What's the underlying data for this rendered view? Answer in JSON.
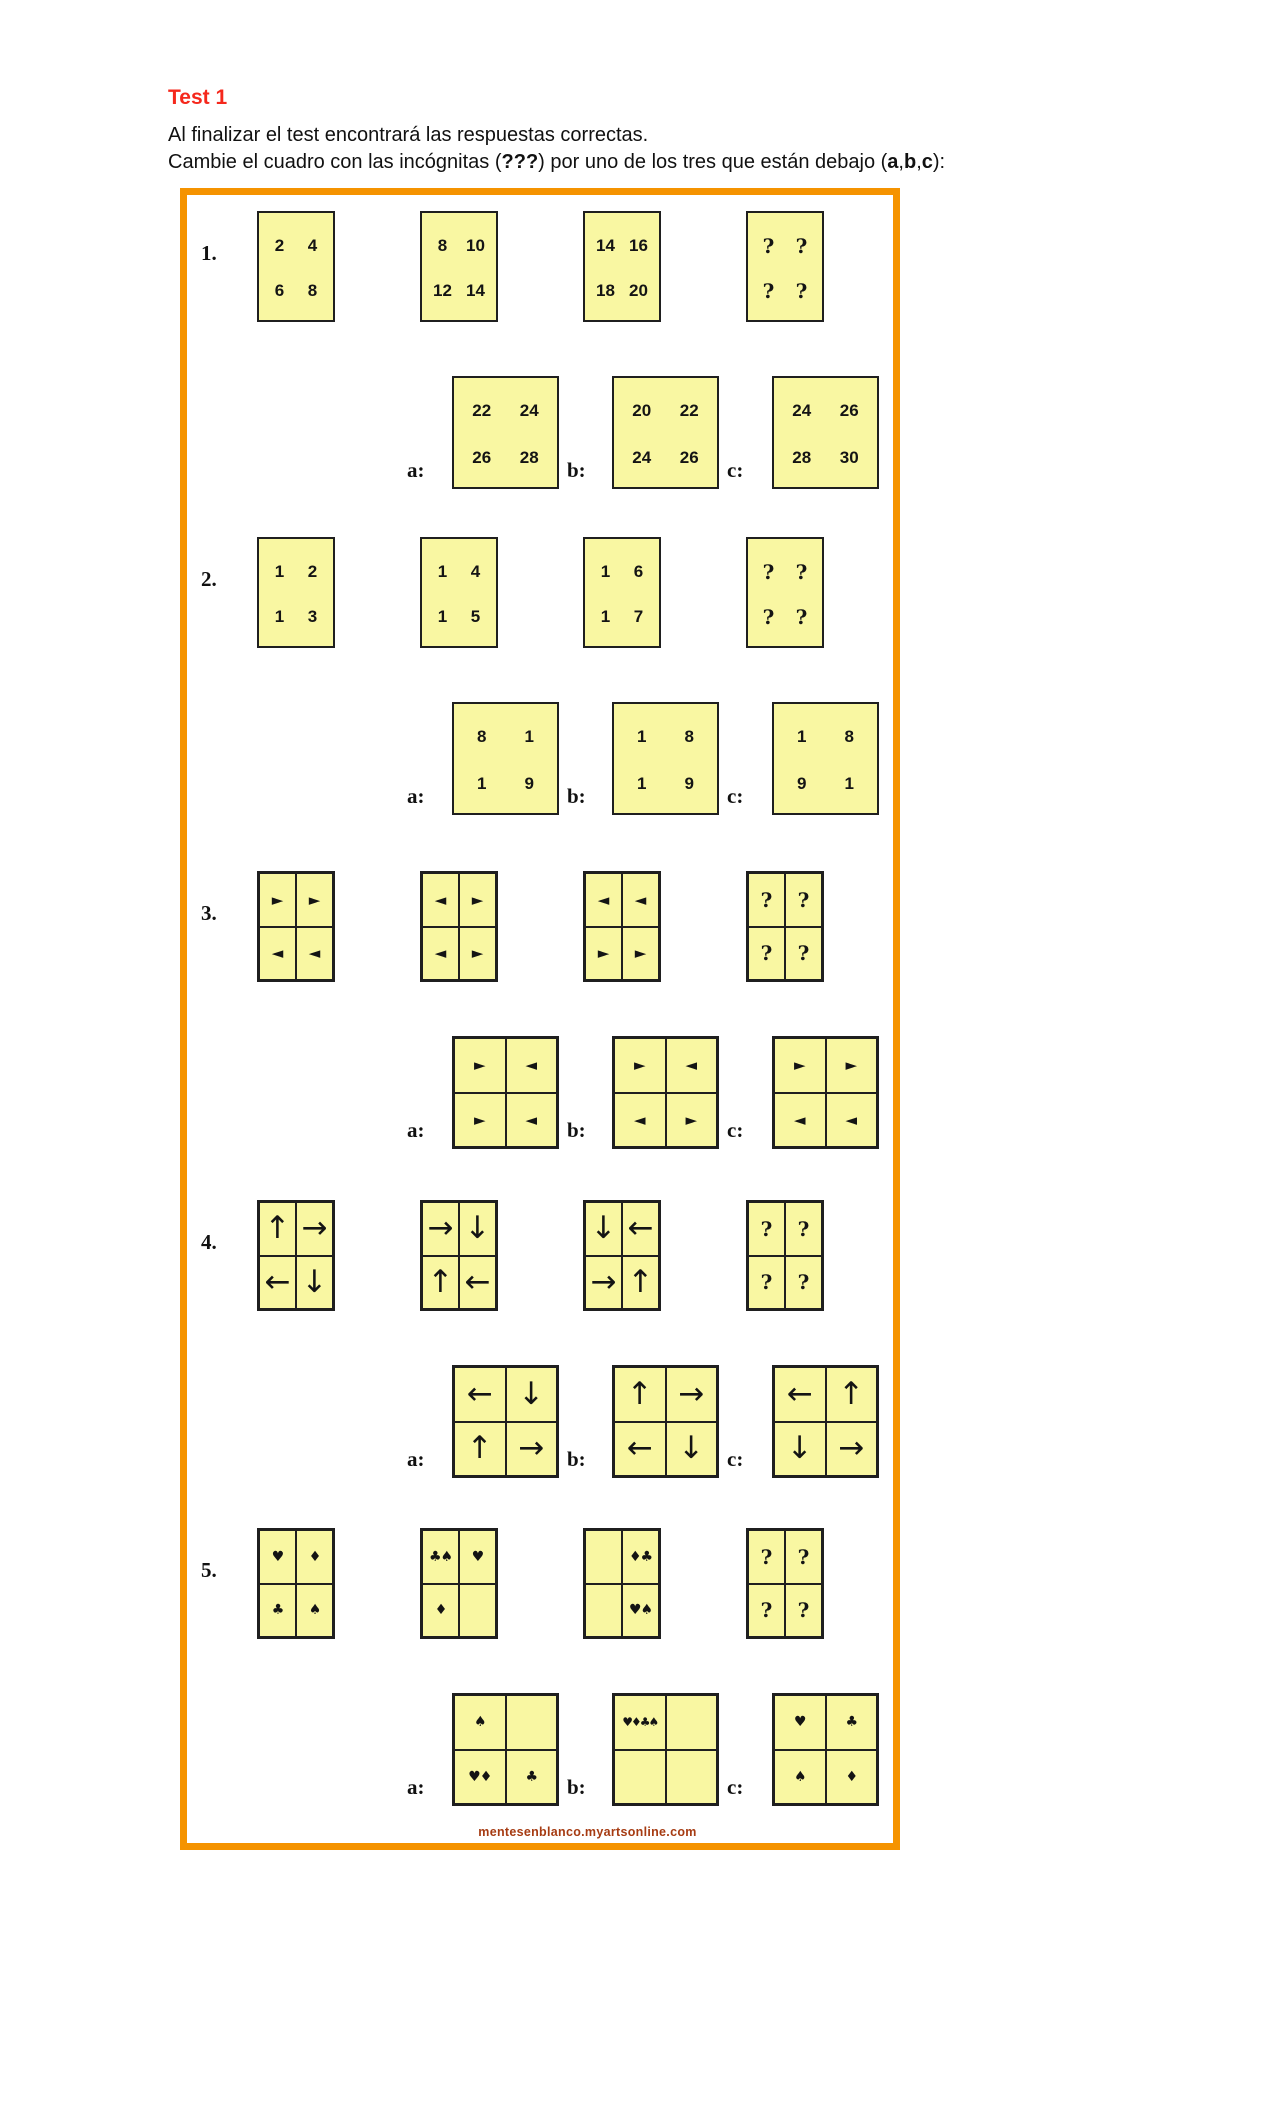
{
  "page": {
    "title": "Test 1",
    "instruction_line1": "Al finalizar el test encontrará las respuestas correctas.",
    "instruction_line2": {
      "pre": "Cambie el cuadro con las incógnitas (",
      "unknowns": "???",
      "mid": ") por uno de los tres que están debajo (",
      "opt_a": "a",
      "comma1": ",",
      "opt_b": "b",
      "comma2": ",",
      "opt_c": "c",
      "post": "):"
    },
    "watermark": "mentesenblanco.myartsonline.com"
  },
  "colors": {
    "title_red": "#f5281c",
    "box_border_orange": "#f59300",
    "grid_fill_yellow": "#f9f7a2",
    "grid_border": "#1f1f1f",
    "watermark_brown": "#a63b12"
  },
  "puzzles": [
    {
      "number": "1.",
      "type": "numbers",
      "divided": false,
      "sequence": [
        {
          "cells": [
            "2",
            "4",
            "6",
            "8"
          ]
        },
        {
          "cells": [
            "8",
            "10",
            "12",
            "14"
          ]
        },
        {
          "cells": [
            "14",
            "16",
            "18",
            "20"
          ]
        },
        {
          "cells": [
            "?",
            "?",
            "?",
            "?"
          ]
        }
      ],
      "options": [
        {
          "label": "a:",
          "cells": [
            "22",
            "24",
            "26",
            "28"
          ]
        },
        {
          "label": "b:",
          "cells": [
            "20",
            "22",
            "24",
            "26"
          ]
        },
        {
          "label": "c:",
          "cells": [
            "24",
            "26",
            "28",
            "30"
          ]
        }
      ]
    },
    {
      "number": "2.",
      "type": "numbers",
      "divided": false,
      "sequence": [
        {
          "cells": [
            "1",
            "2",
            "1",
            "3"
          ]
        },
        {
          "cells": [
            "1",
            "4",
            "1",
            "5"
          ]
        },
        {
          "cells": [
            "1",
            "6",
            "1",
            "7"
          ]
        },
        {
          "cells": [
            "?",
            "?",
            "?",
            "?"
          ]
        }
      ],
      "options": [
        {
          "label": "a:",
          "cells": [
            "8",
            "1",
            "1",
            "9"
          ]
        },
        {
          "label": "b:",
          "cells": [
            "1",
            "8",
            "1",
            "9"
          ]
        },
        {
          "label": "c:",
          "cells": [
            "1",
            "8",
            "9",
            "1"
          ]
        }
      ]
    },
    {
      "number": "3.",
      "type": "triangles",
      "divided": true,
      "sequence": [
        {
          "cells": [
            "►",
            "►",
            "◄",
            "◄"
          ]
        },
        {
          "cells": [
            "◄",
            "►",
            "◄",
            "►"
          ]
        },
        {
          "cells": [
            "◄",
            "◄",
            "►",
            "►"
          ]
        },
        {
          "cells": [
            "?",
            "?",
            "?",
            "?"
          ]
        }
      ],
      "options": [
        {
          "label": "a:",
          "cells": [
            "►",
            "◄",
            "►",
            "◄"
          ]
        },
        {
          "label": "b:",
          "cells": [
            "►",
            "◄",
            "◄",
            "►"
          ]
        },
        {
          "label": "c:",
          "cells": [
            "►",
            "►",
            "◄",
            "◄"
          ]
        }
      ]
    },
    {
      "number": "4.",
      "type": "arrows",
      "divided": true,
      "sequence": [
        {
          "cells": [
            "↑",
            "→",
            "←",
            "↓"
          ]
        },
        {
          "cells": [
            "→",
            "↓",
            "↑",
            "←"
          ]
        },
        {
          "cells": [
            "↓",
            "←",
            "→",
            "↑"
          ]
        },
        {
          "cells": [
            "?",
            "?",
            "?",
            "?"
          ]
        }
      ],
      "options": [
        {
          "label": "a:",
          "cells": [
            "←",
            "↓",
            "↑",
            "→"
          ]
        },
        {
          "label": "b:",
          "cells": [
            "↑",
            "→",
            "←",
            "↓"
          ]
        },
        {
          "label": "c:",
          "cells": [
            "←",
            "↑",
            "↓",
            "→"
          ]
        }
      ]
    },
    {
      "number": "5.",
      "type": "suits",
      "divided": true,
      "sequence": [
        {
          "cells": [
            "♥",
            "♦",
            "♣",
            "♠"
          ]
        },
        {
          "cells": [
            "♣♠",
            "♥",
            "♦",
            ""
          ]
        },
        {
          "cells": [
            "",
            "♦♣",
            "",
            "♥♠"
          ]
        },
        {
          "cells": [
            "?",
            "?",
            "?",
            "?"
          ]
        }
      ],
      "options": [
        {
          "label": "a:",
          "cells": [
            "♠",
            "",
            "♥♦",
            "♣"
          ]
        },
        {
          "label": "b:",
          "cells": [
            "♥♦♣♠",
            "",
            "",
            ""
          ]
        },
        {
          "label": "c:",
          "cells": [
            "♥",
            "♣",
            "♠",
            "♦"
          ]
        }
      ]
    }
  ]
}
